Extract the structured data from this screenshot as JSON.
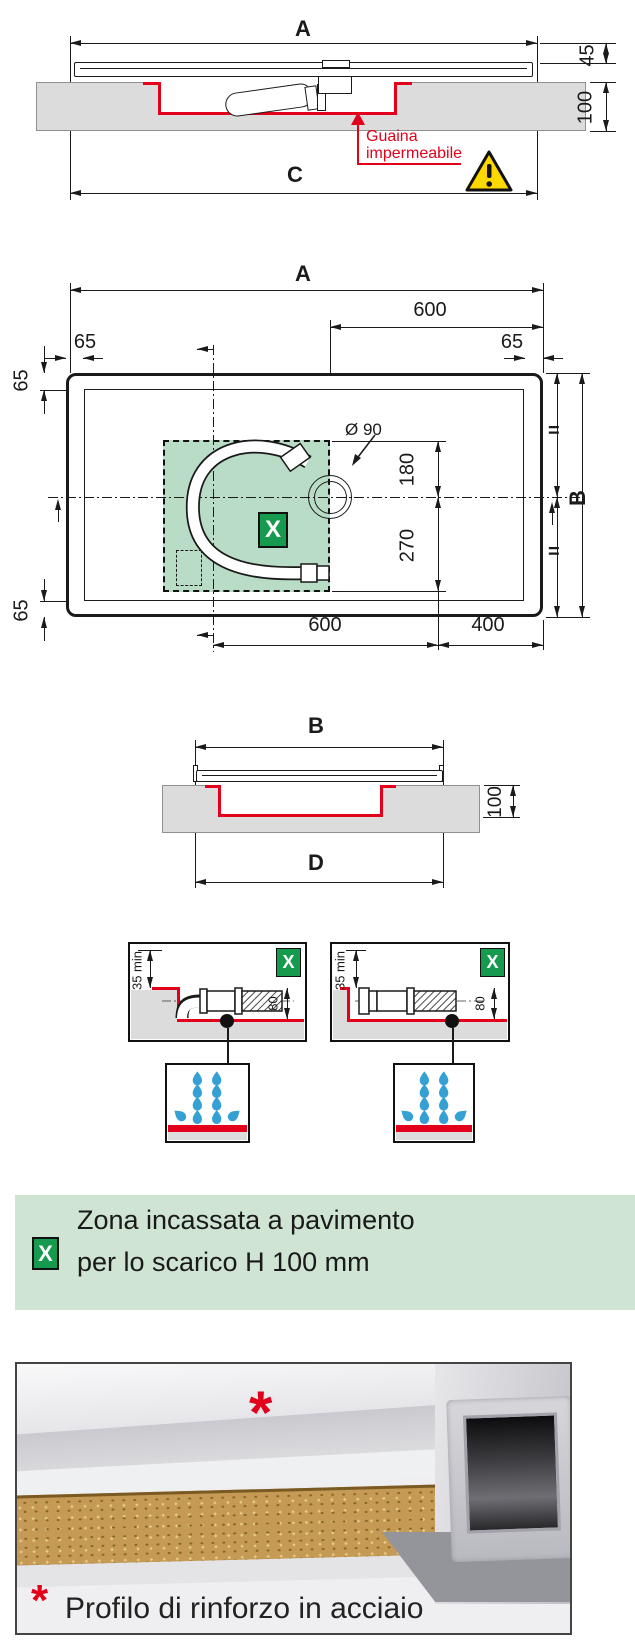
{
  "colors": {
    "line": "#1a1a1a",
    "red": "#e2001a",
    "slab_gray": "#dcdcdc",
    "zone_green": "#b9dcc6",
    "badge_green": "#169b4e",
    "banner_green": "#cfe4d3",
    "drop_blue": "#35a0d4",
    "warning_yellow": "#ffd800"
  },
  "section_a": {
    "dim_a": "A",
    "dim_45": "45",
    "dim_100": "100",
    "dim_c": "C",
    "note_line1": "Guaina",
    "note_line2": "impermeabile"
  },
  "plan": {
    "dim_a": "A",
    "dim_600_top": "600",
    "dim_65_top_left": "65",
    "dim_65_top_right": "65",
    "dim_65_left_top": "65",
    "dim_65_left_bottom": "65",
    "drain_diameter": "Ø 90",
    "dim_180": "180",
    "dim_270": "270",
    "dim_600_bottom": "600",
    "dim_400": "400",
    "dim_b": "B",
    "equal_top": "=",
    "equal_bottom": "=",
    "zone_marker": "X"
  },
  "section_b": {
    "dim_b": "B",
    "dim_100": "100",
    "dim_d": "D"
  },
  "detail_left": {
    "marker": "X",
    "dim_35": "35 min",
    "dim_80": "80"
  },
  "detail_right": {
    "marker": "X",
    "dim_35": "35 min",
    "dim_80": "80"
  },
  "legend": {
    "marker": "X",
    "line1": "Zona incassata a pavimento",
    "line2": "per lo scarico H 100 mm"
  },
  "photo": {
    "marker": "*",
    "caption": "Profilo di rinforzo in acciaio"
  }
}
